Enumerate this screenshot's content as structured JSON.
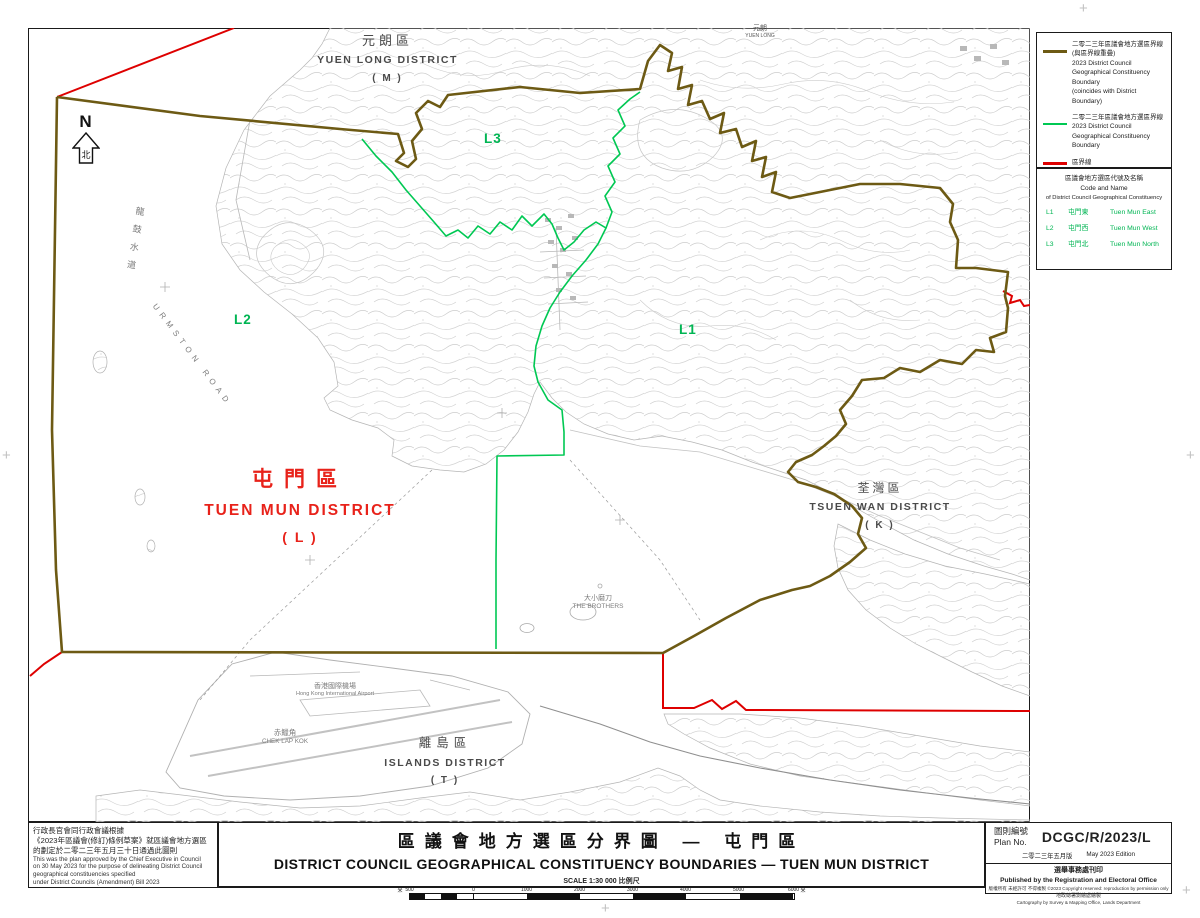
{
  "colors": {
    "boundary_coincident_olive": "#6d5a14",
    "boundary_constituency_green": "#00c853",
    "boundary_district_red": "#de0000",
    "district_title_red": "#e8221a",
    "constituency_code_green": "#00b553"
  },
  "map": {
    "north": {
      "letter": "N",
      "char": "北"
    },
    "district_labels": {
      "yuen_long": {
        "zh": "元朗區",
        "en": "YUEN LONG DISTRICT",
        "code": "( M )"
      },
      "tuen_mun": {
        "zh": "屯門區",
        "en": "TUEN MUN DISTRICT",
        "code": "( L )"
      },
      "tsuen_wan": {
        "zh": "荃灣區",
        "en": "TSUEN WAN DISTRICT",
        "code": "( K )"
      },
      "islands": {
        "zh": "離島區",
        "en": "ISLANDS DISTRICT",
        "code": "( T )"
      }
    },
    "constituency_codes": {
      "l1": "L1",
      "l2": "L2",
      "l3": "L3"
    },
    "features": {
      "urmston_road_zh": "龍鼓水道",
      "urmston_road_en": "URMSTON ROAD",
      "brothers_zh": "大小磨刀",
      "brothers_en": "THE BROTHERS",
      "airport_zh": "香港國際機場",
      "airport_en": "Hong Kong International Airport",
      "chek_lap_kok_zh": "赤鱲角",
      "chek_lap_kok_en": "CHEK LAP KOK",
      "yuen_long_town_zh": "元朗",
      "yuen_long_town_en": "YUEN LONG"
    },
    "registration_mark": "+"
  },
  "legend": {
    "items": [
      {
        "zh1": "二零二三年區議會地方選區界線",
        "zh2": "(與區界線重疊)",
        "en1": "2023 District Council",
        "en2": "Geographical Constituency",
        "en3": "Boundary",
        "en4": "(coincides with District Boundary)"
      },
      {
        "zh1": "二零二三年區議會地方選區界線",
        "en1": "2023 District Council",
        "en2": "Geographical Constituency",
        "en3": "Boundary"
      },
      {
        "zh1": "區界線",
        "en1": "District Boundary"
      }
    ]
  },
  "codes": {
    "title_zh": "區議會地方選區代號及名稱",
    "title_en1": "Code and Name",
    "title_en2": "of District Council Geographical Constituency",
    "items": [
      {
        "code": "L1",
        "zh": "屯門東",
        "en": "Tuen Mun East"
      },
      {
        "code": "L2",
        "zh": "屯門西",
        "en": "Tuen Mun West"
      },
      {
        "code": "L3",
        "zh": "屯門北",
        "en": "Tuen Mun North"
      }
    ]
  },
  "note_block": {
    "zh1": "行政長官會同行政會議根據",
    "zh2": "《2023年區議會(修訂)條例草案》就區議會地方選區",
    "zh3": "的劃定於二零二三年五月三十日通過此圖則",
    "en1": "This was the plan approved by the Chief Executive in Council",
    "en2": "on 30 May 2023 for the purpose of delineating District Council",
    "en3": "geographical constituencies specified",
    "en4": "under District Councils (Amendment) Bill 2023"
  },
  "title_block": {
    "title_zh": "區議會地方選區分界圖 — 屯門區",
    "title_en": "DISTRICT COUNCIL GEOGRAPHICAL CONSTITUENCY BOUNDARIES — TUEN MUN DISTRICT",
    "scale_label": "SCALE 1:30 000 比例尺"
  },
  "scale": {
    "unit": "米",
    "ticks": [
      "500",
      "0",
      "1000",
      "2000",
      "3000",
      "4000",
      "5000",
      "6000"
    ]
  },
  "plan_block": {
    "label_zh": "圖則編號",
    "label_en": "Plan No.",
    "number": "DCGC/R/2023/L",
    "edition_zh": "二零二三年五月版",
    "edition_en": "May 2023 Edition",
    "publisher_zh": "選舉事務處刊印",
    "publisher_en": "Published by the Registration and Electoral Office",
    "copyright": "版權所有 未經許可 不得複製 ©2023 Copyright reserved: reproduction by permission only",
    "cartography_zh": "地政總署測繪處繪製",
    "cartography_en": "Cartography by Survey & Mapping Office, Lands Department"
  }
}
